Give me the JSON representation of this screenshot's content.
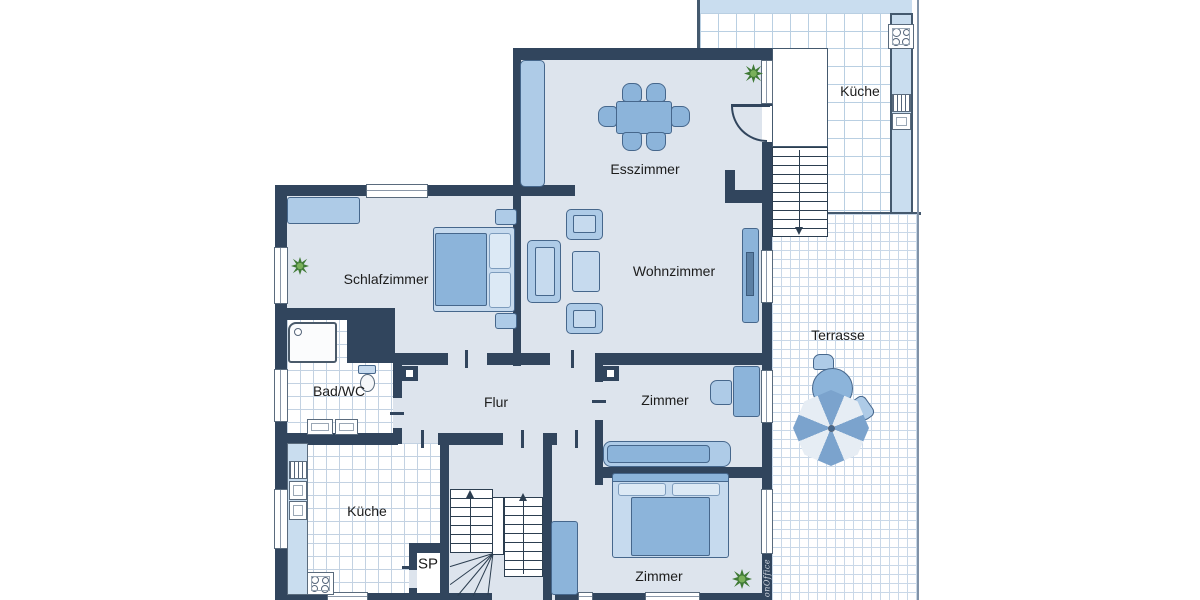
{
  "page": {
    "type": "floorplan",
    "background": "#ffffff"
  },
  "labels": {
    "esszimmer": "Esszimmer",
    "schlafzimmer": "Schlafzimmer",
    "wohnzimmer": "Wohnzimmer",
    "bad_wc": "Bad/WC",
    "flur": "Flur",
    "zimmer_mittel": "Zimmer",
    "zimmer_unten": "Zimmer",
    "kueche_innen": "Küche",
    "kueche_terrasse": "Küche",
    "terrasse": "Terrasse",
    "speisekammer": "SP",
    "watermark": "onOffice"
  },
  "colors": {
    "wall": "#31455d",
    "floor": "#dde4ed",
    "tile_line": "#c3d2e2",
    "terrace_tile_line": "#b9cfe2",
    "furniture": "#8cb4da",
    "furniture_light": "#aecbe7",
    "furniture_pale": "#c6daee",
    "counter": "#c9ddef",
    "umbrella_dark": "#7ba3cd",
    "umbrella_light": "#e6edf4",
    "plant_dark": "#3f7a35",
    "plant_light": "#79b05a",
    "text": "#1c1c1c"
  }
}
